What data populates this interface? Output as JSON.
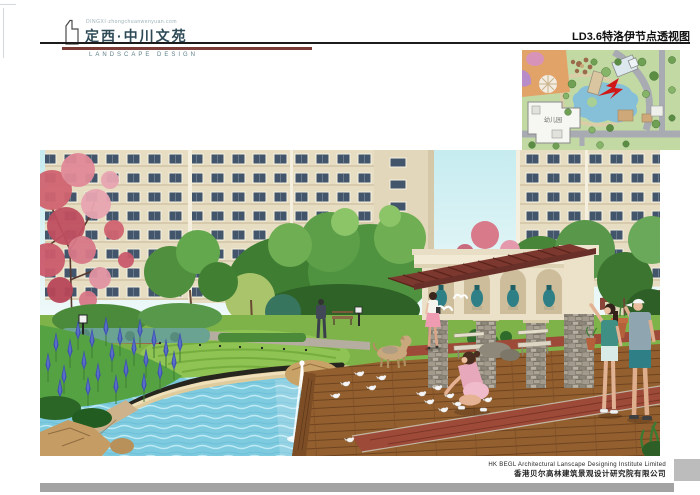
{
  "header": {
    "logo": {
      "tagline": "DINGXI·zhongchuanwenyuan.com",
      "title": "定西·中川文苑",
      "subtitle": "LANDSCAPE DESIGN"
    },
    "sheet_title": "LD3.6特洛伊节点透视图"
  },
  "site_plan": {
    "kindergarten_label": "幼儿园",
    "marker": "red-viewpoint-arrow"
  },
  "footer": {
    "company_en": "HK BEGL Architectural Lanscape Designing Institute Limited",
    "company_cn": "香港贝尔高林建筑景观设计研究院有限公司"
  },
  "icons": {
    "logo_mark": "tower-outline-icon"
  },
  "colors": {
    "logo_text": "#2e4a56",
    "subtitle_text": "#5f8089",
    "rule_black": "#1c1c1c",
    "rule_maroon": "#7a3a35",
    "footer_bar": "#a3a3a3",
    "plan_marker_red": "#d01818",
    "pond_water": "#7ecadf",
    "deck_wood": "#935f2e",
    "pergola_roof": "#7c382e"
  }
}
